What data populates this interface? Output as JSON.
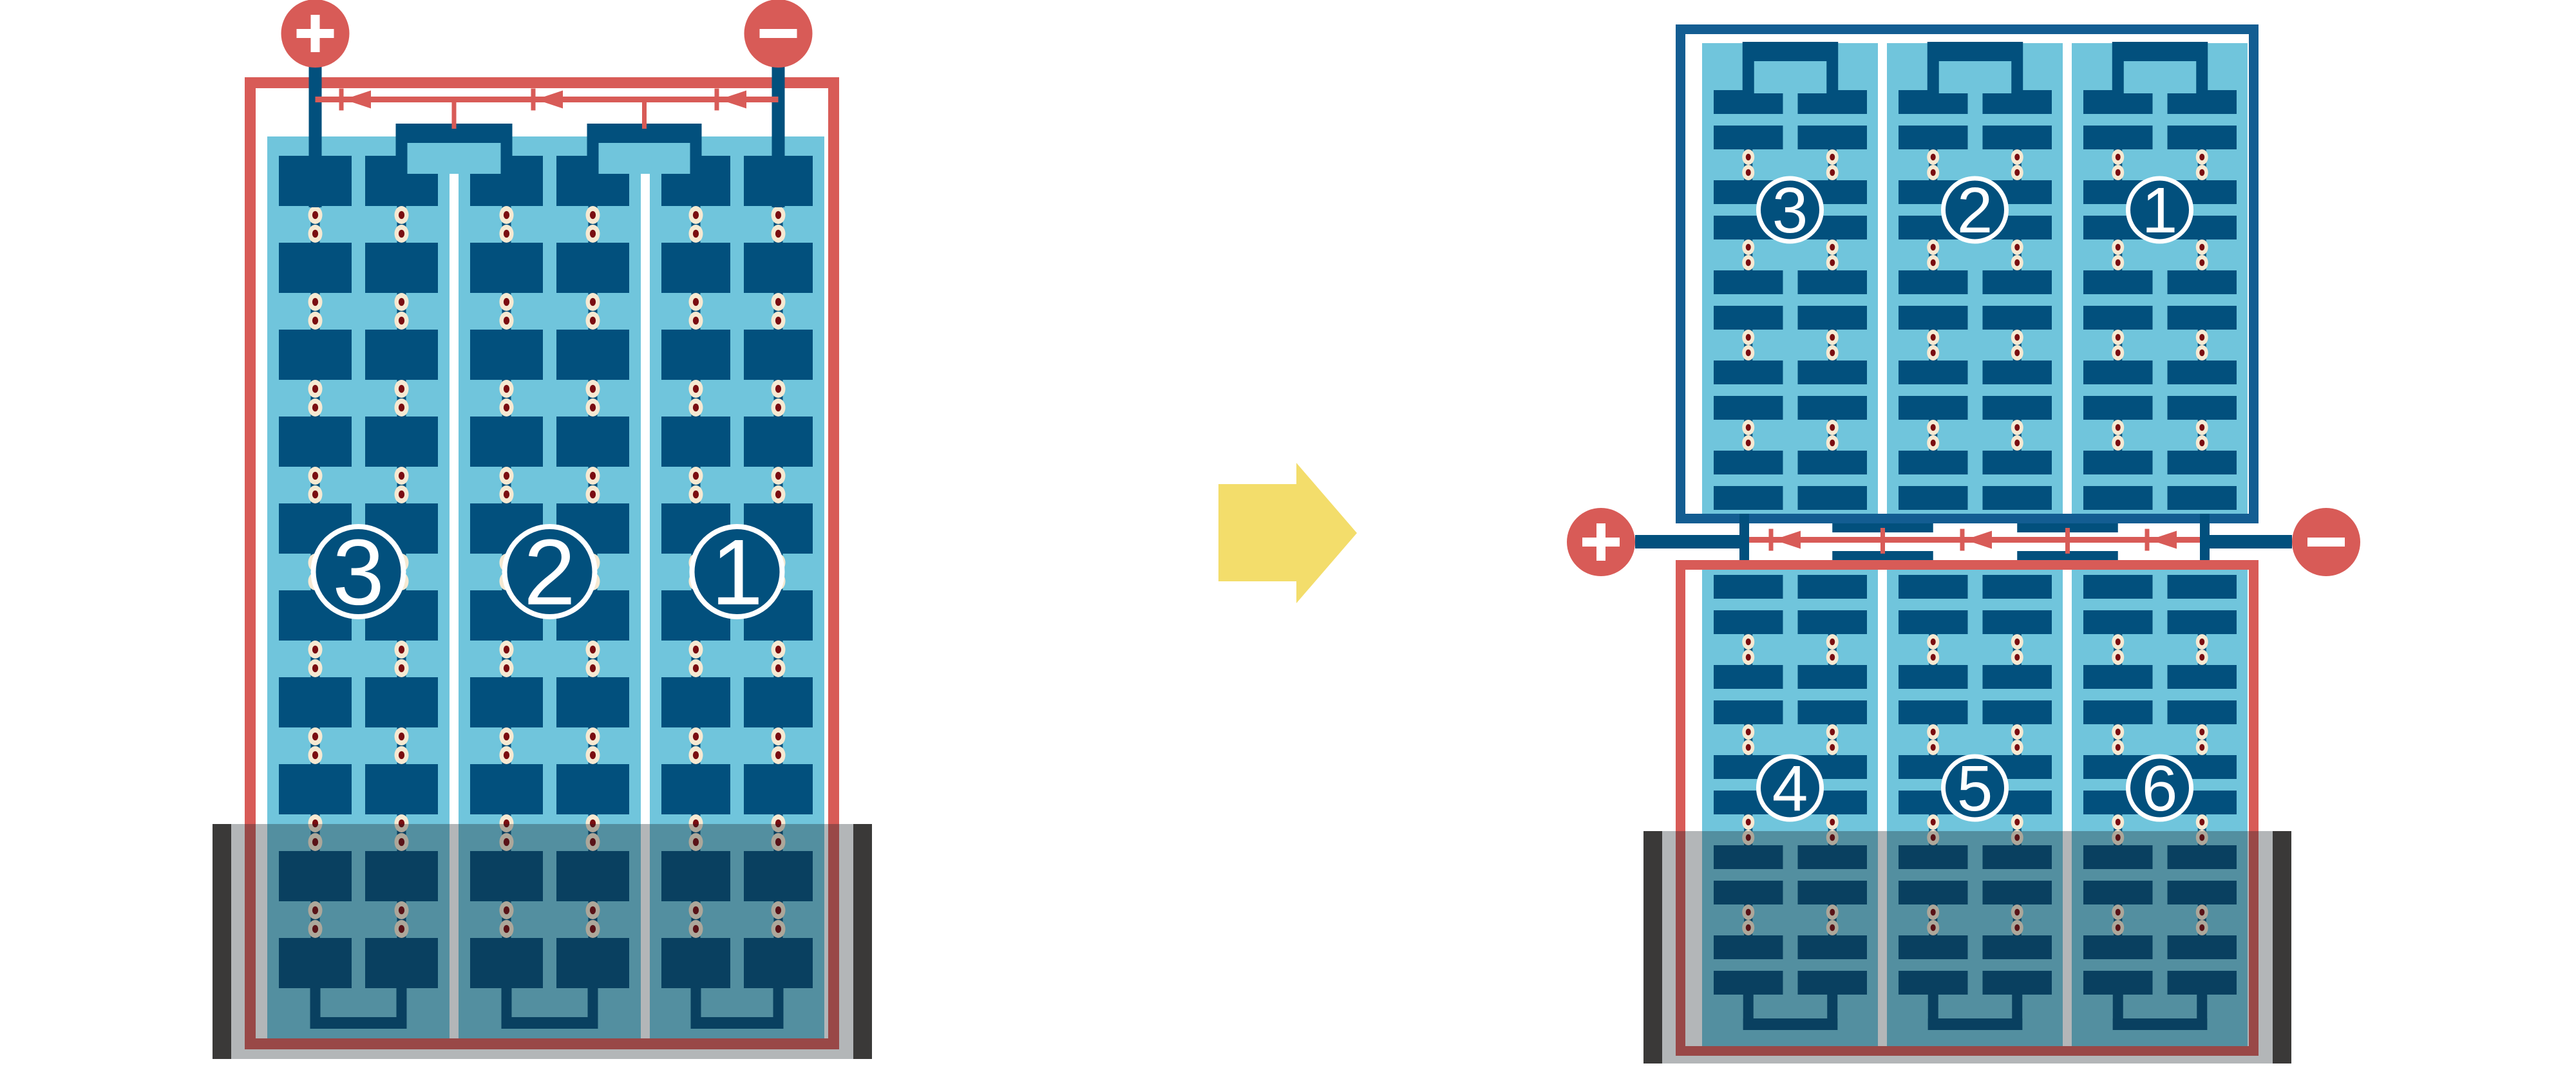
{
  "colors": {
    "background": "#FFFFFF",
    "sky": "#70C5DC",
    "cell_navy": "#02507D",
    "frame_blue": "#135D92",
    "red": "#D85B57",
    "dot_ring": "#F6E9D2",
    "dot_core": "#7A0D11",
    "shade_overlay": "rgba(25,32,38,0.33)",
    "shade_bar": "#3A3938",
    "arrow_yellow": "#F3DD6B",
    "label_text": "#FFFFFF"
  },
  "left_module": {
    "terminals": [
      {
        "symbol": "+",
        "polarity": "positive"
      },
      {
        "symbol": "−",
        "polarity": "negative"
      }
    ],
    "cell_strings": [
      {
        "label": "3"
      },
      {
        "label": "2"
      },
      {
        "label": "1"
      }
    ],
    "bypass_diode_count": 3,
    "shaded_bottom": true
  },
  "right_modules": {
    "top": {
      "frame_color_key": "frame_blue",
      "cell_strings": [
        {
          "label": "3"
        },
        {
          "label": "2"
        },
        {
          "label": "1"
        }
      ]
    },
    "bottom": {
      "frame_color_key": "red",
      "cell_strings": [
        {
          "label": "4"
        },
        {
          "label": "5"
        },
        {
          "label": "6"
        }
      ],
      "shaded_bottom": true
    },
    "terminals": [
      {
        "symbol": "+",
        "polarity": "positive"
      },
      {
        "symbol": "−",
        "polarity": "negative"
      }
    ],
    "bypass_diode_count": 3
  },
  "transition_arrow": {
    "direction": "right"
  }
}
